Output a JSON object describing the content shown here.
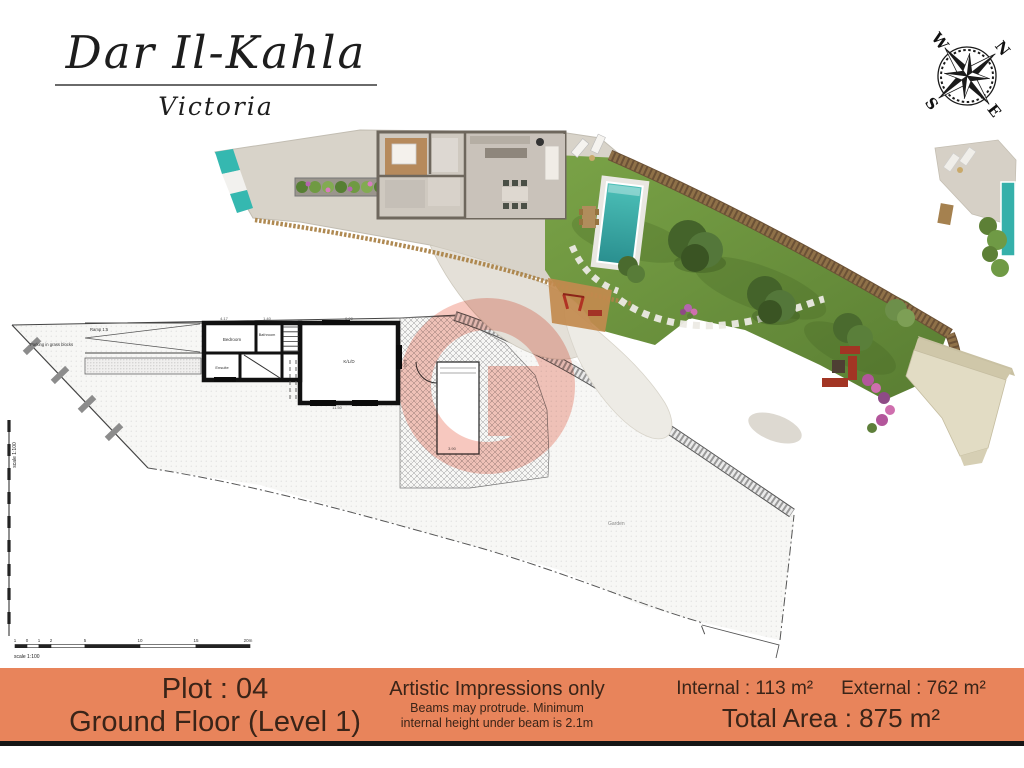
{
  "header": {
    "title": "Dar Il-Kahla",
    "subtitle": "Victoria"
  },
  "compass": {
    "n": "N",
    "e": "E",
    "s": "S",
    "w": "W"
  },
  "floor_plan": {
    "labels": {
      "ramp": "Ramp 1:5",
      "parking": "Parking in grass blocks",
      "bedroom": "Bedroom",
      "bathroom": "Bathroom",
      "ensuite": "Ensuite",
      "main_room": "K/L/D",
      "garden": "Garden"
    },
    "dims": [
      "4.17",
      "1.40",
      "9.00",
      "11.50",
      "4.50",
      "3.90"
    ],
    "scale_label": "scale 1:100",
    "scale_ticks": [
      "1",
      "0",
      "1",
      "2",
      "5",
      "10",
      "15",
      "20m"
    ]
  },
  "footer": {
    "plot": "Plot : 04",
    "floor": "Ground Floor (Level 1)",
    "disclaimer_title": "Artistic Impressions only",
    "disclaimer_line1": "Beams may protrude. Minimum",
    "disclaimer_line2": "internal height under beam is 2.1m",
    "internal": "Internal : 113 m²",
    "external": "External : 762 m²",
    "total": "Total Area : 875 m²"
  },
  "colors": {
    "footer_bar": "#e8845b",
    "footer_text": "#3a2418",
    "watermark": "#ef9180",
    "pool": "#35b0aa",
    "lawn": "#6f923f",
    "stone_wall": "#8a6a45"
  }
}
